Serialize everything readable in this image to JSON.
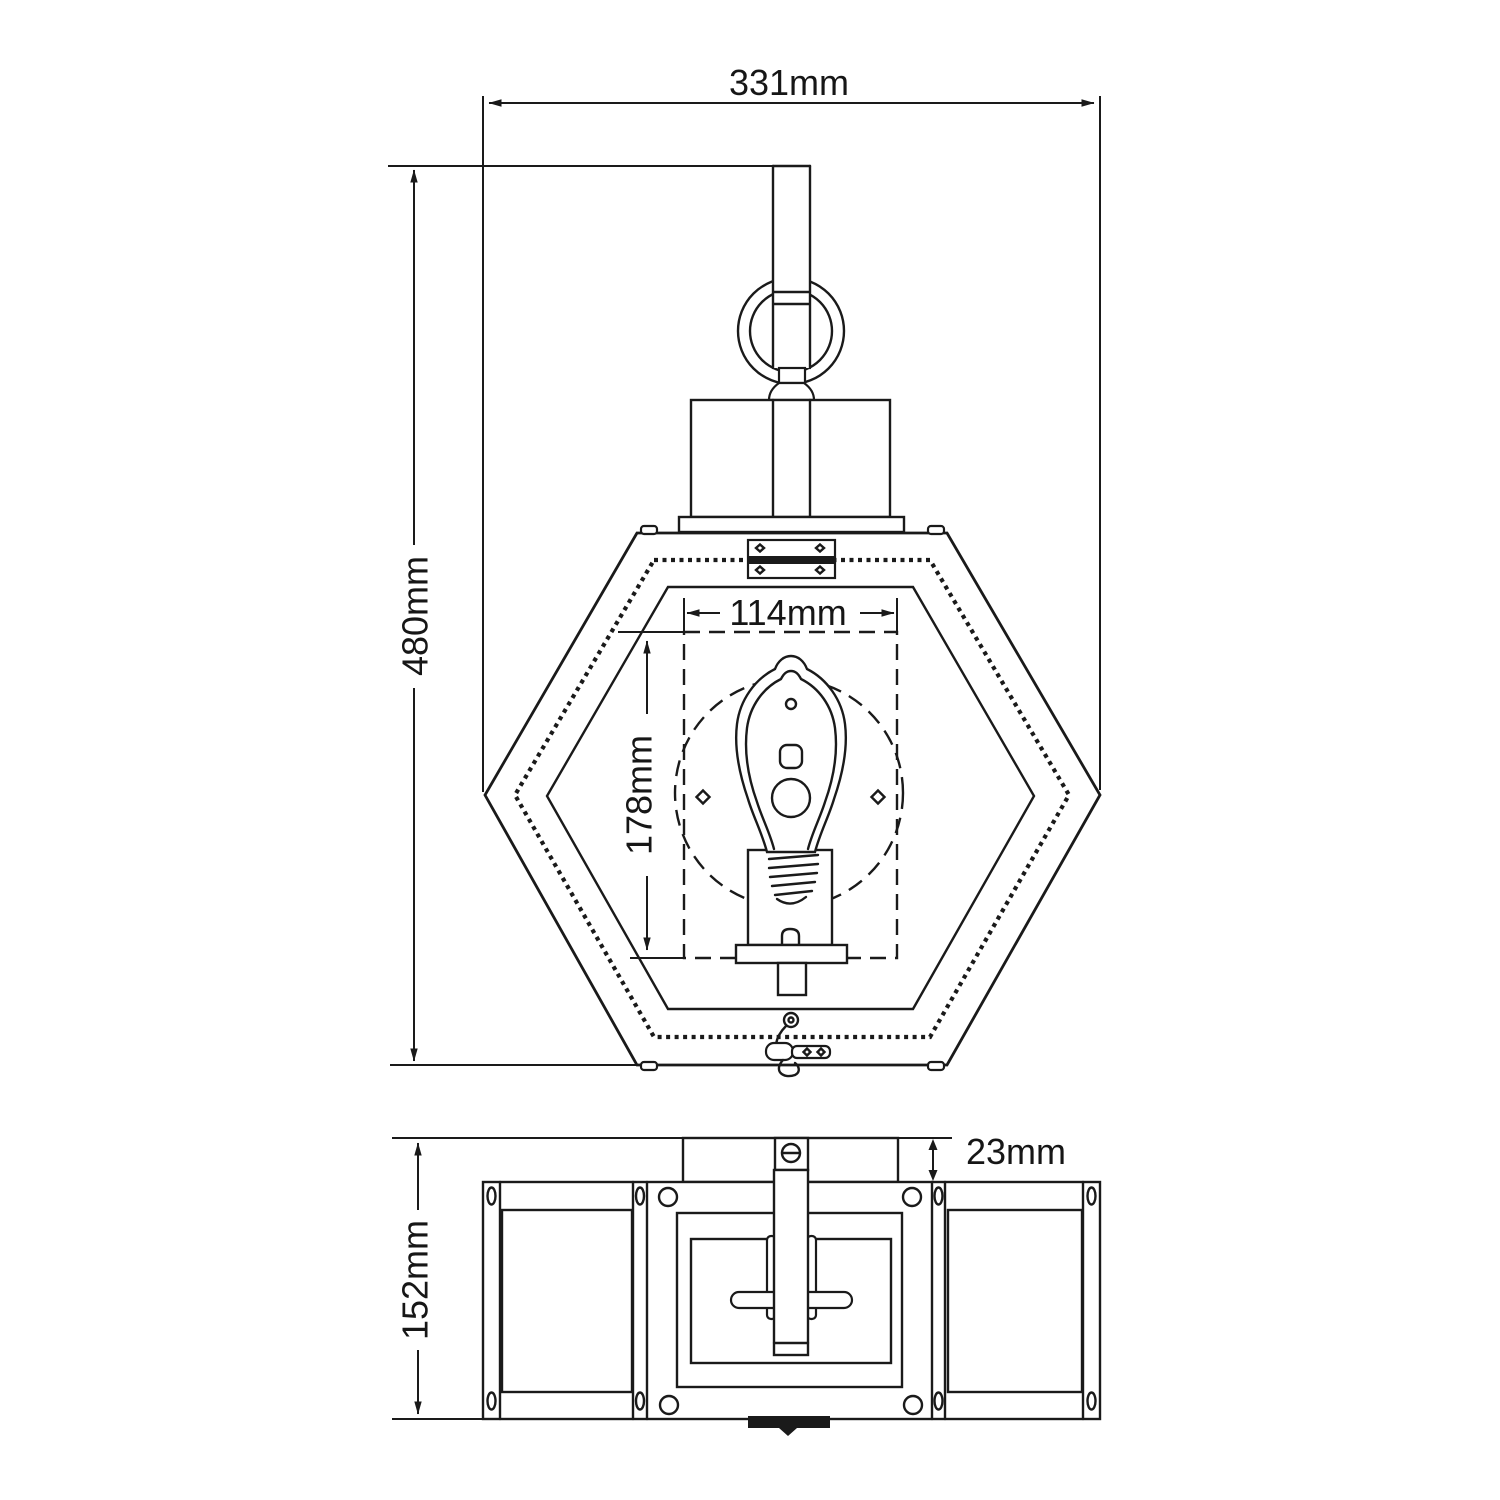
{
  "meta": {
    "title": "Hexagonal wall lantern technical dimension drawing",
    "views": [
      "front elevation",
      "plan view"
    ]
  },
  "front_view": {
    "overall_width": "331mm",
    "overall_height": "480mm",
    "bulb_area_width": "114mm",
    "bulb_area_height": "178mm"
  },
  "plan_view": {
    "depth": "152mm",
    "backplate_depth": "23mm"
  },
  "colors": {
    "ink": "#1a1a1a",
    "paper": "#ffffff"
  }
}
